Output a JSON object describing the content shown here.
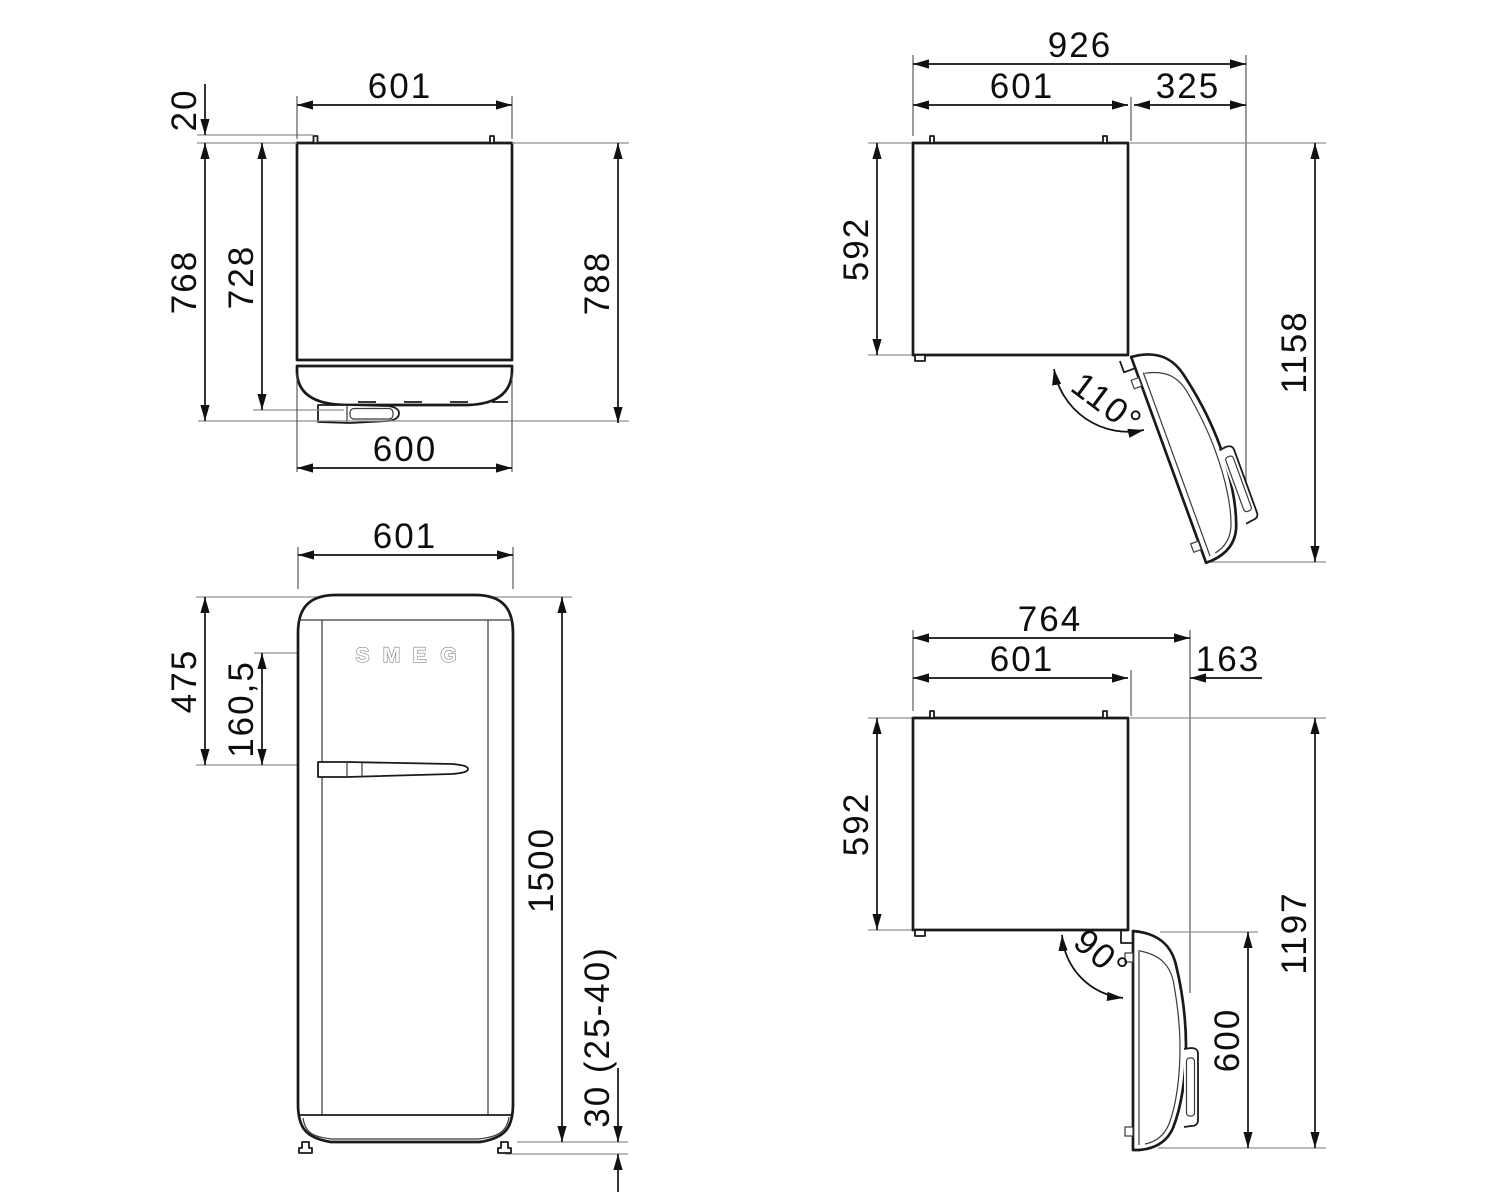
{
  "views": {
    "top_closed": {
      "top_width": "601",
      "rear_gap": "20",
      "depth_body": "728",
      "depth_with_door": "768",
      "depth_with_handle": "788",
      "front_width": "600"
    },
    "door_110": {
      "overall_width": "926",
      "body_width": "601",
      "door_side": "325",
      "body_depth": "592",
      "overall_depth": "1158",
      "angle": "110°"
    },
    "front": {
      "width": "601",
      "top_to_handle": "475",
      "logo_to_handle": "160,5",
      "height": "1500",
      "feet_height": "30 (25-40)",
      "logo": [
        "S",
        "M",
        "E",
        "G"
      ]
    },
    "door_90": {
      "overall_width": "764",
      "body_width": "601",
      "door_side": "163",
      "body_depth": "592",
      "overall_depth": "1197",
      "door_width": "600",
      "angle": "90°"
    }
  }
}
